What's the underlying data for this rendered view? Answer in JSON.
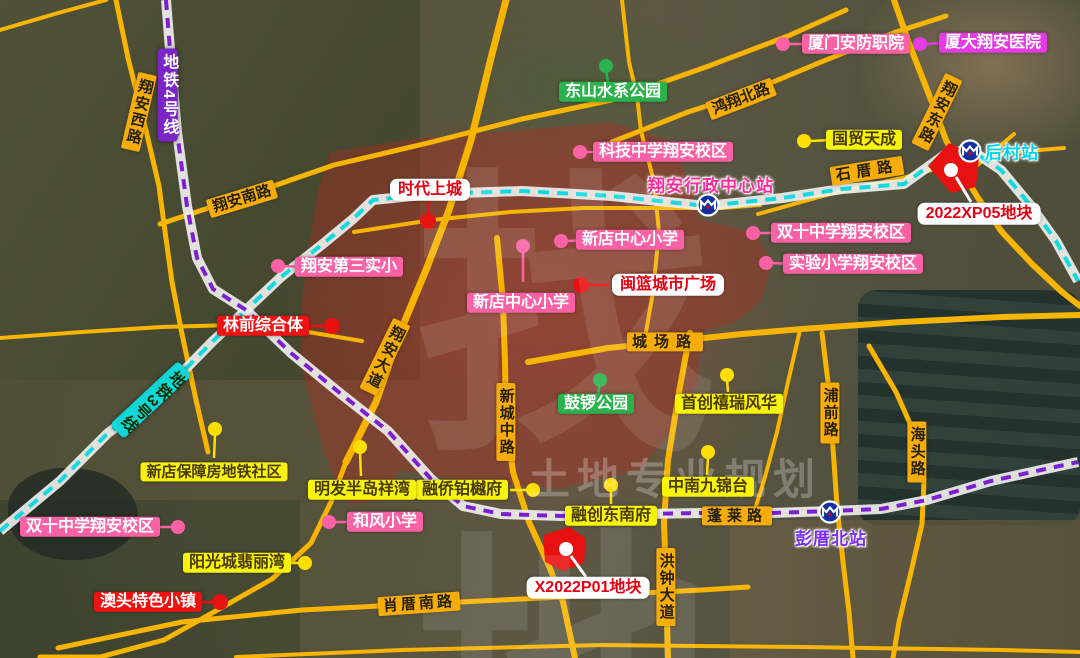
{
  "metro": {
    "line4_label": "地铁4号线",
    "line3_label": "地铁3号线",
    "station_xingzheng": "翔安行政中心站",
    "station_houcun": "后村站",
    "station_pengcuobei": "彭厝北站"
  },
  "roads": [
    "翔安西路",
    "翔安南路",
    "鸿翔北路",
    "翔安东路",
    "石厝路",
    "城场路",
    "新城中路",
    "翔安大道",
    "蓬莱路",
    "浦前路",
    "海头路",
    "洪钟大道",
    "肖厝南路"
  ],
  "pois": {
    "pink": [
      "厦门安防职院",
      "科技中学翔安校区",
      "新店中心小学",
      "新店中心小学",
      "翔安第三实小",
      "双十中学翔安校区",
      "实验小学翔安校区",
      "双十中学翔安校区",
      "和风小学"
    ],
    "magenta": [
      "厦大翔安医院"
    ],
    "green": [
      "东山水系公园",
      "鼓锣公园"
    ],
    "yellow": [
      "国贸天成",
      "首创禧瑞风华",
      "中南九锦台",
      "融创东南府",
      "融侨铂樾府",
      "新店保障房地铁社区",
      "明发半岛祥湾",
      "阳光城翡丽湾"
    ],
    "red": [
      "林前综合体",
      "澳头特色小镇"
    ],
    "white": [
      "时代上城",
      "闽篮城市广场"
    ]
  },
  "plots": [
    "2022XP05地块",
    "X2022P01地块"
  ],
  "watermark": {
    "logo": "找地",
    "caption": "土地专业规划"
  },
  "colors": {
    "road": "#F7B500",
    "road_label_bg": "#F6AD0A",
    "poi_yellow_bg": "#F7F40A",
    "pink_bg": "#FA62A5",
    "magenta_bg": "#E43BE4",
    "green_bg": "#2CB24C",
    "red_bg": "#EE1212",
    "plot_red": "#E81111",
    "line3_dash": "#12D8E0",
    "line4_dash": "#7B1FD0",
    "metro_icon_blue": "#10309F",
    "red_zone": "rgba(187,39,26,0.34)"
  }
}
